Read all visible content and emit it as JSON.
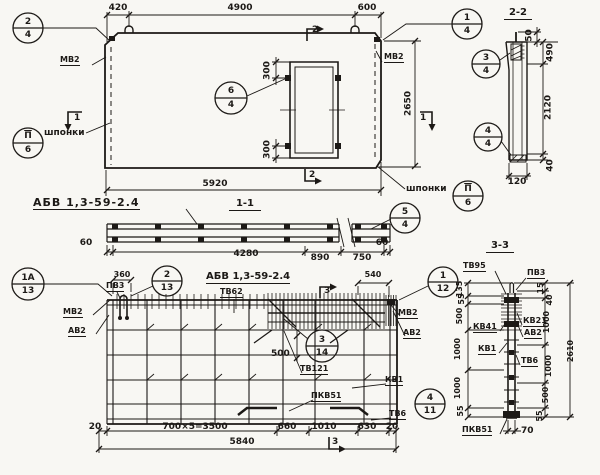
{
  "plan": {
    "dims": {
      "d420": "420",
      "d4900": "4900",
      "d600": "600",
      "d5920": "5920",
      "d2650": "2650",
      "d300t": "300",
      "d300b": "300"
    },
    "labels": {
      "mv2_left": "МВ2",
      "mv2_right": "МВ2",
      "shponki_left": "шпонки",
      "shponki_right": "шпонки"
    },
    "marks": {
      "m1_left": "1",
      "m1_right": "1",
      "m2_top": "2",
      "m2_bottom": "2"
    },
    "callouts": {
      "c24": {
        "top": "2",
        "bottom": "4"
      },
      "c14": {
        "top": "1",
        "bottom": "4"
      },
      "c64": {
        "top": "6",
        "bottom": "4"
      },
      "csh_left": {
        "top": "П",
        "bottom": "6"
      },
      "csh_right": {
        "top": "П",
        "bottom": "6"
      }
    }
  },
  "section_2_2": {
    "title": "2-2",
    "callouts": {
      "c34": {
        "top": "3",
        "bottom": "4"
      },
      "c44": {
        "top": "4",
        "bottom": "4"
      }
    },
    "dims": {
      "d50": "50",
      "d490": "490",
      "d2120": "2120",
      "d40": "40",
      "d120": "120"
    }
  },
  "section_1_1": {
    "label": "АБВ 1,3-59-2.4",
    "title": "1-1",
    "callouts": {
      "c54": {
        "top": "5",
        "bottom": "4"
      }
    },
    "dims": {
      "d60l": "60",
      "d4280": "4280",
      "d890": "890",
      "d750": "750",
      "d60r": "60"
    }
  },
  "rebar_plan": {
    "title": "АБВ 1,3-59-2.4",
    "subtitle": "ТВ62",
    "labels": {
      "pv3": "ПВ3",
      "mv2_left": "МВ2",
      "av2_left": "АВ2",
      "mv2_right": "МВ2",
      "av2_right": "АВ2",
      "tv121": "ТВ121",
      "kv1": "КВ1",
      "pkv51": "ПКВ51",
      "tv6": "ТВ6"
    },
    "marks": {
      "m3_top": "3",
      "m3_bottom": "3"
    },
    "callouts": {
      "c1a13": {
        "top": "1А",
        "bottom": "13"
      },
      "c213": {
        "top": "2",
        "bottom": "13"
      },
      "c112": {
        "top": "1",
        "bottom": "12"
      },
      "c314": {
        "top": "3",
        "bottom": "14"
      },
      "c411": {
        "top": "4",
        "bottom": "11"
      }
    },
    "dims": {
      "d360": "360",
      "d540": "540",
      "d500": "500",
      "d20l": "20",
      "d3500": "700×5=3500",
      "d660": "660",
      "d1010": "1010",
      "d630": "630",
      "d20r": "20",
      "d5840": "5840"
    }
  },
  "section_3_3": {
    "title": "3-3",
    "labels": {
      "tv95": "ТВ95",
      "pv3": "ПВ3",
      "kv41": "КВ41",
      "kv1": "КВ1",
      "kv21": "КВ21",
      "av2": "АВ2",
      "tv6": "ТВ6",
      "pkv51": "ПКВ51"
    },
    "dims_left": {
      "d135": "135",
      "d55t": "55",
      "d500": "500",
      "d1000a": "1000",
      "d1000b": "1000",
      "d55b": "55"
    },
    "dims_right": {
      "d15": "15",
      "d40": "40",
      "d1000a": "1000",
      "d1000b": "1000",
      "d500": "500",
      "d55": "55"
    },
    "dims": {
      "d2610": "2610",
      "d70": "70"
    }
  }
}
